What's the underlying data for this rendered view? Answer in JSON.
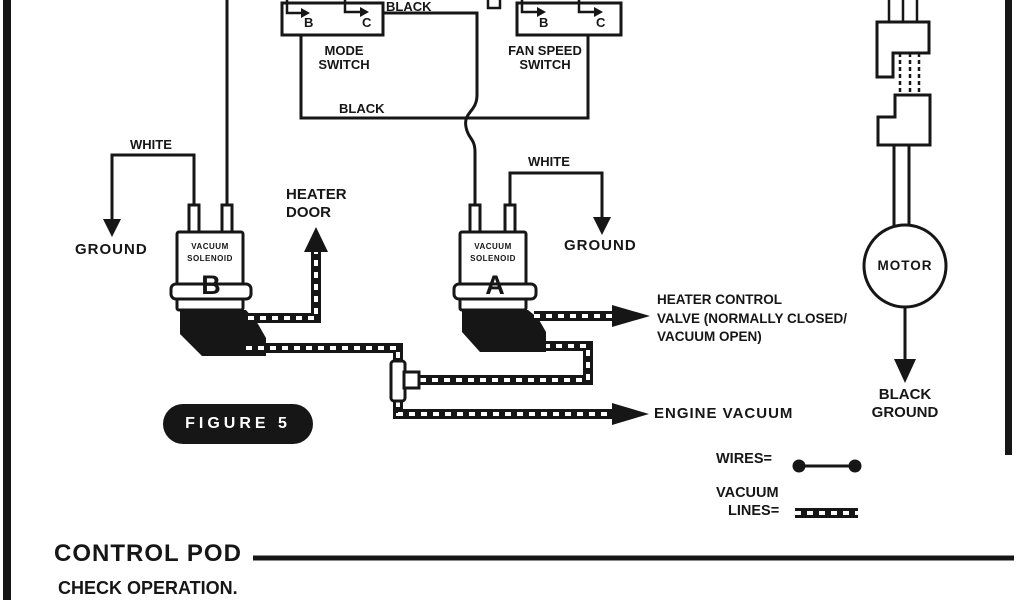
{
  "figure": {
    "label": "FIGURE 5"
  },
  "switches": {
    "mode": {
      "line1": "MODE",
      "line2": "SWITCH",
      "terminal_b": "B",
      "terminal_c": "C"
    },
    "fan_speed": {
      "line1": "FAN SPEED",
      "line2": "SWITCH",
      "terminal_b": "B",
      "terminal_c": "C"
    }
  },
  "wire_labels": {
    "black_top": "BLACK",
    "black_bottom": "BLACK",
    "white_left": "WHITE",
    "white_right": "WHITE",
    "ground_left": "GROUND",
    "ground_right": "GROUND"
  },
  "solenoid_b": {
    "line1": "VACUUM",
    "line2": "SOLENOID",
    "tag": "B"
  },
  "solenoid_a": {
    "line1": "VACUUM",
    "line2": "SOLENOID",
    "tag": "A"
  },
  "heater_door": {
    "line1": "HEATER",
    "line2": "DOOR"
  },
  "heater_valve": {
    "line1": "HEATER CONTROL",
    "line2": "VALVE (NORMALLY CLOSED/",
    "line3": "VACUUM OPEN)"
  },
  "engine_vacuum": "ENGINE VACUUM",
  "motor": {
    "label": "MOTOR",
    "ground_line1": "BLACK",
    "ground_line2": "GROUND"
  },
  "legend": {
    "wires": "WIRES=",
    "vacuum_line1": "VACUUM",
    "vacuum_line2": "LINES="
  },
  "footer": {
    "title": "CONTROL POD",
    "note": "CHECK OPERATION."
  },
  "colors": {
    "ink": "#161616",
    "paper": "#ffffff"
  }
}
